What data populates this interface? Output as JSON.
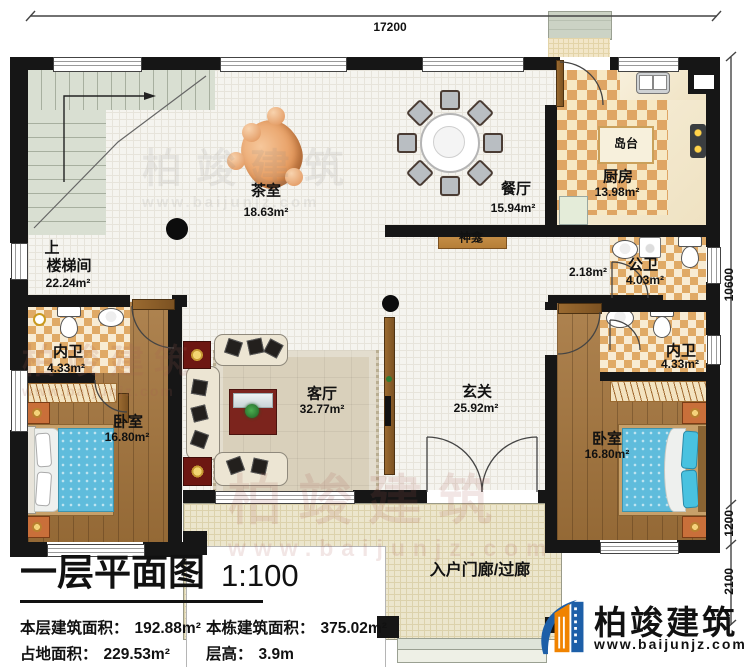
{
  "dimensions": {
    "top": "17200",
    "right_upper": "10600",
    "right_middle": "1200",
    "right_lower": "2100"
  },
  "watermark": {
    "name": "柏竣建筑",
    "url": "www.baijunjz.com"
  },
  "rooms": {
    "stair_direction": "上",
    "stairwell": {
      "name": "楼梯间",
      "area": "22.24m²"
    },
    "tea": {
      "name": "茶室",
      "area": "18.63m²"
    },
    "dining": {
      "name": "餐厅",
      "area": "15.94m²"
    },
    "kitchen": {
      "name": "厨房",
      "area": "13.98m²"
    },
    "island": {
      "name": "岛台"
    },
    "shrine": {
      "name": "神龛"
    },
    "corridor": {
      "area": "2.18m²"
    },
    "public_bath": {
      "name": "公卫",
      "area": "4.03m²"
    },
    "bath_left": {
      "name": "内卫",
      "area": "4.33m²"
    },
    "bath_right": {
      "name": "内卫",
      "area": "4.33m²"
    },
    "bedroom_left": {
      "name": "卧室",
      "area": "16.80m²"
    },
    "bedroom_right": {
      "name": "卧室",
      "area": "16.80m²"
    },
    "living": {
      "name": "客厅",
      "area": "32.77m²"
    },
    "foyer": {
      "name": "玄关",
      "area": "25.92m²"
    },
    "porch": {
      "name": "入户门廊/过廊"
    }
  },
  "title_block": {
    "title": "一层平面图",
    "scale": "1:100",
    "stats": [
      {
        "label": "本层建筑面积：",
        "value": "192.88m²"
      },
      {
        "label": "本栋建筑面积：",
        "value": "375.02m²"
      },
      {
        "label": "占地面积：",
        "value": "229.53m²"
      },
      {
        "label": "层高：",
        "value": "3.9m"
      }
    ]
  },
  "logo": {
    "name": "柏竣建筑",
    "url": "www.baijunjz.com"
  }
}
